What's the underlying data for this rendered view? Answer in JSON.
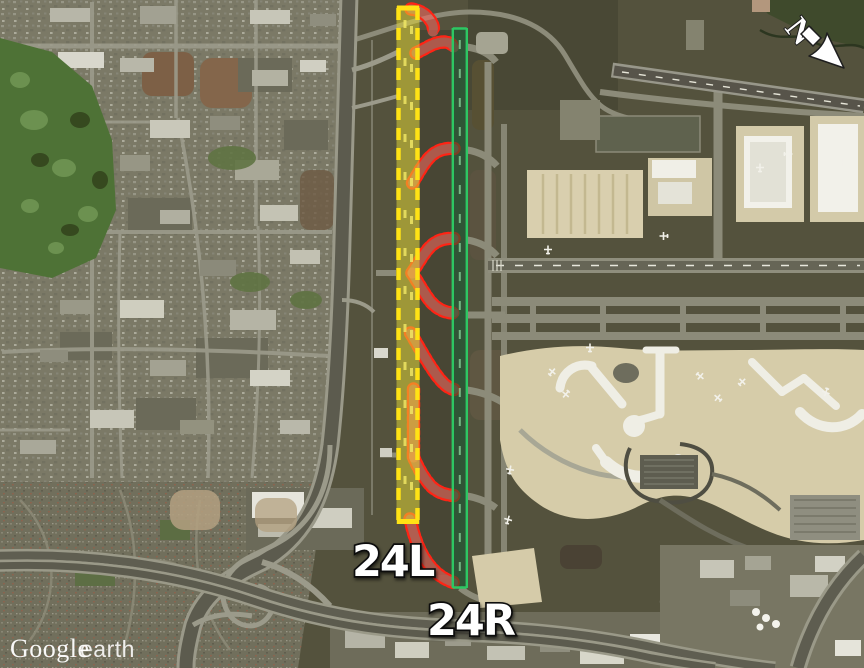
{
  "map_view": {
    "annotations": {
      "runway_left_label": "24L",
      "runway_right_label": "24R"
    },
    "compass": {
      "letter": "N"
    },
    "watermark": {
      "brand": "Google",
      "product": "earth"
    },
    "overlays": {
      "runway_24L": {
        "fill_color": "rgba(232,220,52,0.5)",
        "edge_color": "#ffe215",
        "edge_style": "dashed"
      },
      "runway_24R": {
        "fill_color": "rgba(16,88,50,0.55)",
        "edge_color": "#2dc763",
        "edge_style": "solid"
      },
      "exit_taxiways": {
        "fill_color": "rgba(240,104,94,0.6)",
        "edge_color": "#ff2415",
        "edge_style": "dashed"
      }
    }
  }
}
